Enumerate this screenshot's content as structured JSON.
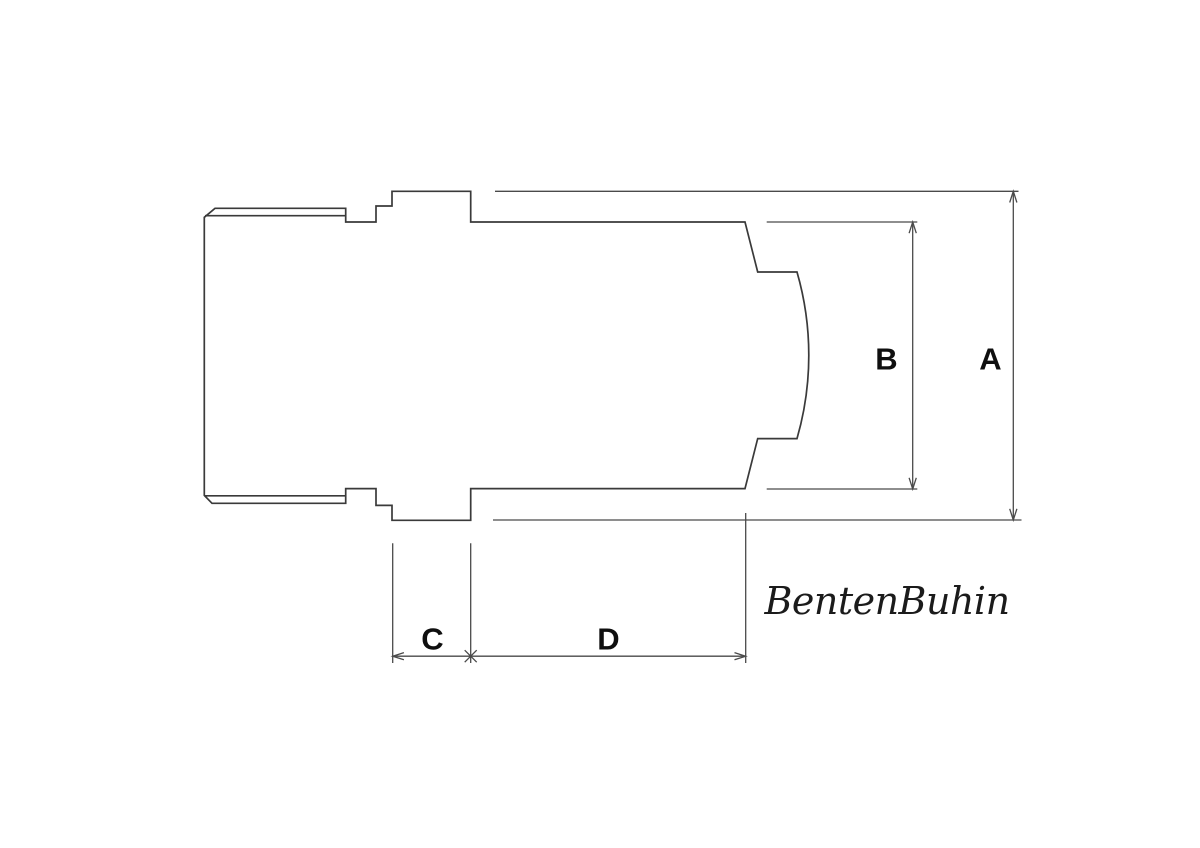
{
  "dimensions": {
    "a": {
      "label": "A"
    },
    "b": {
      "label": "B"
    },
    "c": {
      "label": "C"
    },
    "d": {
      "label": "D"
    }
  },
  "watermark": {
    "text": "BentenBuhin"
  },
  "colors": {
    "part_line": "#3a3a3a",
    "dimension_line": "#4a4a4a",
    "label_text": "#0f0f0f",
    "signature_text": "#1b1b1b",
    "background": "#ffffff"
  }
}
